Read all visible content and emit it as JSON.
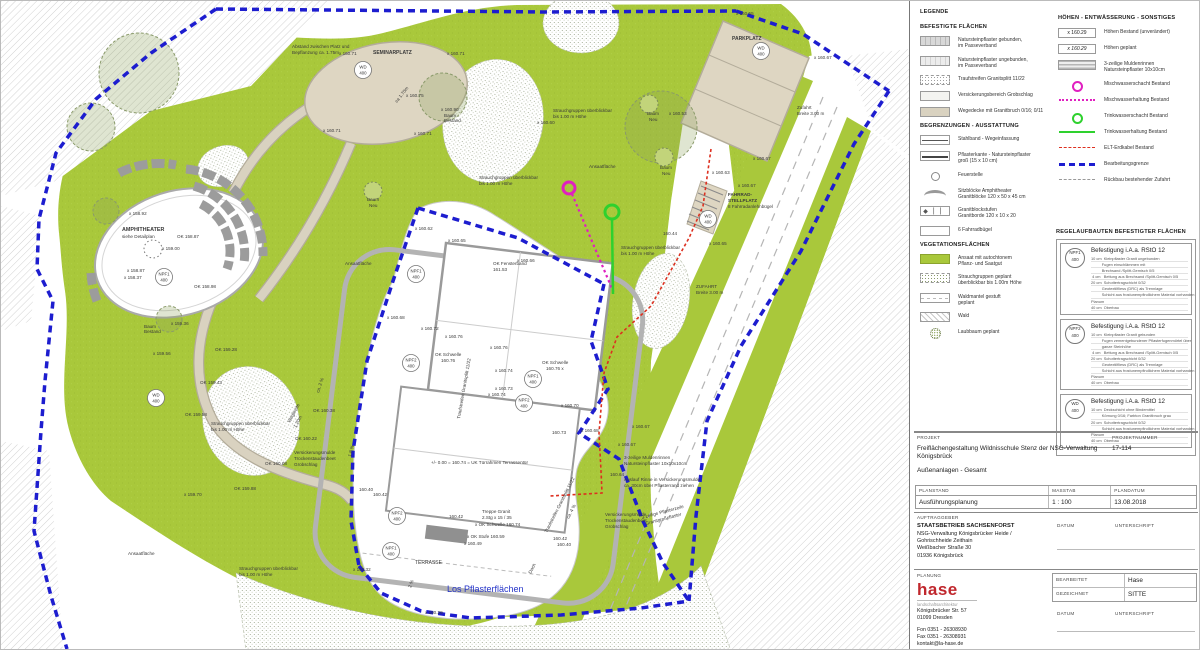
{
  "plan": {
    "colors": {
      "green": "#a9c83b",
      "beige": "#d9d2c0",
      "beige_edge": "#b3ac9a",
      "boundary_blue": "#1d1dcf",
      "sewer_magenta": "#e020c0",
      "water_green": "#2ed12e",
      "cable_red": "#dd3020",
      "label_blue": "#2433c8"
    },
    "labels": [
      {
        "t": "x 158.92",
        "x": 128,
        "y": 214
      },
      {
        "t": "AMPHITHEATER",
        "x": 121,
        "y": 230,
        "b": 1,
        "s": 5.4
      },
      {
        "t": "siehe Detailplan",
        "x": 121,
        "y": 237
      },
      {
        "t": "OK 158.87",
        "x": 176,
        "y": 237
      },
      {
        "t": "x 159.00",
        "x": 161,
        "y": 249
      },
      {
        "t": "x 158.87",
        "x": 126,
        "y": 271
      },
      {
        "t": "x 158.37",
        "x": 123,
        "y": 278
      },
      {
        "t": "OK 158.98",
        "x": 193,
        "y": 287
      },
      {
        "t": "Baum",
        "x": 143,
        "y": 327
      },
      {
        "t": "Bestand",
        "x": 143,
        "y": 332
      },
      {
        "t": "x 159.36",
        "x": 170,
        "y": 324
      },
      {
        "t": "x 159.56",
        "x": 152,
        "y": 354
      },
      {
        "t": "Abstand zwischen Platz und",
        "x": 291,
        "y": 47
      },
      {
        "t": "Bepflanzung ca. 1.75m",
        "x": 291,
        "y": 53
      },
      {
        "t": "x 160.71",
        "x": 338,
        "y": 54
      },
      {
        "t": "SEMINARPLATZ",
        "x": 372,
        "y": 53,
        "b": 1,
        "s": 5
      },
      {
        "t": "x 160.71",
        "x": 446,
        "y": 54
      },
      {
        "t": "x 160.75",
        "x": 405,
        "y": 96
      },
      {
        "t": "ca 1.70m",
        "x": 396,
        "y": 102,
        "r": -52
      },
      {
        "t": "x 160.90",
        "x": 440,
        "y": 110
      },
      {
        "t": "Baum",
        "x": 443,
        "y": 116
      },
      {
        "t": "Bestand",
        "x": 443,
        "y": 121
      },
      {
        "t": "x 160.71",
        "x": 322,
        "y": 131
      },
      {
        "t": "x 160.71",
        "x": 413,
        "y": 134
      },
      {
        "t": "x 160.55",
        "x": 735,
        "y": 14
      },
      {
        "t": "PARKPLATZ",
        "x": 731,
        "y": 39,
        "b": 1,
        "s": 5
      },
      {
        "t": "x 160.67",
        "x": 813,
        "y": 58
      },
      {
        "t": "Zufahrt",
        "x": 796,
        "y": 108
      },
      {
        "t": "Breite 3.00 m",
        "x": 796,
        "y": 114
      },
      {
        "t": "x 160.53",
        "x": 668,
        "y": 114
      },
      {
        "t": "x 160.67",
        "x": 752,
        "y": 159
      },
      {
        "t": "x 160.63",
        "x": 711,
        "y": 173
      },
      {
        "t": "x 160.67",
        "x": 737,
        "y": 186
      },
      {
        "t": "FAHRRAD-",
        "x": 727,
        "y": 195,
        "b": 1
      },
      {
        "t": "STELLPLATZ",
        "x": 727,
        "y": 201,
        "b": 1
      },
      {
        "t": "8 Fahrradanlehnbügel",
        "x": 727,
        "y": 207
      },
      {
        "t": "160.44",
        "x": 662,
        "y": 234
      },
      {
        "t": "x 160.65",
        "x": 708,
        "y": 244
      },
      {
        "t": "ZUFAHRT",
        "x": 695,
        "y": 287
      },
      {
        "t": "Breite 3.00 m",
        "x": 695,
        "y": 293
      },
      {
        "t": "x 160.60",
        "x": 536,
        "y": 123
      },
      {
        "t": "Strauchgruppen überblickbar",
        "x": 552,
        "y": 111
      },
      {
        "t": "bis 1.00 m Höhe",
        "x": 552,
        "y": 117
      },
      {
        "t": "Ansaatfläche",
        "x": 588,
        "y": 167
      },
      {
        "t": "Baum",
        "x": 646,
        "y": 114
      },
      {
        "t": "Neu",
        "x": 648,
        "y": 120
      },
      {
        "t": "Baum",
        "x": 659,
        "y": 168
      },
      {
        "t": "Neu",
        "x": 661,
        "y": 174
      },
      {
        "t": "Baum",
        "x": 366,
        "y": 200
      },
      {
        "t": "Neu",
        "x": 368,
        "y": 206
      },
      {
        "t": "Strauchgruppen überblickbar",
        "x": 478,
        "y": 178
      },
      {
        "t": "bis 1.00 m Höhe",
        "x": 478,
        "y": 184
      },
      {
        "t": "Strauchgruppen überblickbar",
        "x": 620,
        "y": 248
      },
      {
        "t": "bis 1.00 m Höhe",
        "x": 620,
        "y": 254
      },
      {
        "t": "Ansaatfläche",
        "x": 344,
        "y": 264
      },
      {
        "t": "OK 159.28",
        "x": 214,
        "y": 350
      },
      {
        "t": "OK 159.43",
        "x": 199,
        "y": 383
      },
      {
        "t": "OK 159.58",
        "x": 184,
        "y": 415
      },
      {
        "t": "Strauchgruppen überblickbar",
        "x": 210,
        "y": 424
      },
      {
        "t": "bis 1.00 m Höhe",
        "x": 210,
        "y": 430
      },
      {
        "t": "ca. 2 %",
        "x": 318,
        "y": 392,
        "r": -72
      },
      {
        "t": "Wegbreite",
        "x": 289,
        "y": 422,
        "r": -62
      },
      {
        "t": "1.20m",
        "x": 295,
        "y": 427,
        "r": -62
      },
      {
        "t": "OK 160.38",
        "x": 312,
        "y": 411
      },
      {
        "t": "OK 160.22",
        "x": 294,
        "y": 439
      },
      {
        "t": "OK 160.08",
        "x": 264,
        "y": 464
      },
      {
        "t": "Versickerungsmulde",
        "x": 293,
        "y": 453
      },
      {
        "t": "Trockenstaudenbeet",
        "x": 293,
        "y": 459
      },
      {
        "t": "Grobschlag",
        "x": 293,
        "y": 465
      },
      {
        "t": "x 159.70",
        "x": 183,
        "y": 495
      },
      {
        "t": "OK 159.88",
        "x": 233,
        "y": 489
      },
      {
        "t": "Ansaatfläche",
        "x": 127,
        "y": 554
      },
      {
        "t": "Strauchgruppen überblickbar",
        "x": 238,
        "y": 569
      },
      {
        "t": "bis 1.00 m Höhe",
        "x": 238,
        "y": 575
      },
      {
        "t": "x 160.62",
        "x": 414,
        "y": 229
      },
      {
        "t": "x 160.65",
        "x": 447,
        "y": 241
      },
      {
        "t": "OK Fensterband",
        "x": 492,
        "y": 264
      },
      {
        "t": "161.53",
        "x": 492,
        "y": 270
      },
      {
        "t": "x 160.66",
        "x": 516,
        "y": 261
      },
      {
        "t": "x 160.68",
        "x": 386,
        "y": 318
      },
      {
        "t": "x 160.72",
        "x": 420,
        "y": 329
      },
      {
        "t": "x 160.76",
        "x": 444,
        "y": 337
      },
      {
        "t": "OK Schwelle",
        "x": 434,
        "y": 355
      },
      {
        "t": "160.76",
        "x": 440,
        "y": 361
      },
      {
        "t": "x 160.76",
        "x": 489,
        "y": 348
      },
      {
        "t": "OK Schwelle",
        "x": 541,
        "y": 363
      },
      {
        "t": "160.76 x",
        "x": 545,
        "y": 369
      },
      {
        "t": "x 160.74",
        "x": 494,
        "y": 371
      },
      {
        "t": "x 160.73",
        "x": 494,
        "y": 389
      },
      {
        "t": "x 160.74",
        "x": 487,
        "y": 395
      },
      {
        "t": "x 160.70",
        "x": 560,
        "y": 406
      },
      {
        "t": "160.73",
        "x": 551,
        "y": 433
      },
      {
        "t": "x 160.68",
        "x": 580,
        "y": 431
      },
      {
        "t": "1.8 %",
        "x": 350,
        "y": 456,
        "r": -75
      },
      {
        "t": "Traufstreifen Granitsplitt 11/22",
        "x": 459,
        "y": 418,
        "r": -80
      },
      {
        "t": "Traufstreifen Granitsplitt 11/22",
        "x": 546,
        "y": 532,
        "r": -63
      },
      {
        "t": "+/-  0.00 = 160.74 = UK Türrahmen Terrassentür",
        "x": 430,
        "y": 463
      },
      {
        "t": "ca. 4 %",
        "x": 568,
        "y": 518,
        "r": -63
      },
      {
        "t": "Dach",
        "x": 530,
        "y": 573,
        "r": -63
      },
      {
        "t": "160.40",
        "x": 358,
        "y": 490
      },
      {
        "t": "160.42",
        "x": 372,
        "y": 495
      },
      {
        "t": "160.42",
        "x": 448,
        "y": 517
      },
      {
        "t": "Treppe Granit",
        "x": 481,
        "y": 512
      },
      {
        "t": "2.Stg x 15 / 35",
        "x": 481,
        "y": 518
      },
      {
        "t": "x OK Schwelle 160.74",
        "x": 474,
        "y": 525
      },
      {
        "t": "x OK Stufe 160.59",
        "x": 466,
        "y": 537
      },
      {
        "t": "x 160.49",
        "x": 463,
        "y": 544
      },
      {
        "t": "160.42",
        "x": 552,
        "y": 539
      },
      {
        "t": "160.40",
        "x": 556,
        "y": 545
      },
      {
        "t": "TERRASSE",
        "x": 414,
        "y": 563,
        "s": 5
      },
      {
        "t": "x 160.32",
        "x": 352,
        "y": 570
      },
      {
        "t": "2 %",
        "x": 410,
        "y": 587,
        "r": -70
      },
      {
        "t": "Los Pflasterflächen",
        "x": 446,
        "y": 591,
        "s": 9,
        "c": "#2433c8"
      },
      {
        "t": "x 160.29",
        "x": 424,
        "y": 613
      },
      {
        "t": "x 160.67",
        "x": 631,
        "y": 427
      },
      {
        "t": "x 160.67",
        "x": 617,
        "y": 445
      },
      {
        "t": "160.64",
        "x": 609,
        "y": 475
      },
      {
        "t": "3-zeilige Muldenrinnen",
        "x": 623,
        "y": 458
      },
      {
        "t": "Natursteinpflaster 10x10x10cm",
        "x": 623,
        "y": 464
      },
      {
        "t": "Auslauf Rinne in Versickerungsmulde",
        "x": 623,
        "y": 480
      },
      {
        "t": "ca. 30cm über Pflasterrand ziehen",
        "x": 623,
        "y": 486
      },
      {
        "t": "Versickerungsmulde",
        "x": 604,
        "y": 515
      },
      {
        "t": "Trockenstaudenbeet",
        "x": 604,
        "y": 521
      },
      {
        "t": "Grobschlag",
        "x": 604,
        "y": 527
      },
      {
        "t": "3-zeilige Pflasterzeile",
        "x": 641,
        "y": 518,
        "r": -15
      },
      {
        "t": "Granitgroßpflaster",
        "x": 645,
        "y": 524,
        "r": -15
      }
    ],
    "badges": [
      {
        "l1": "NPF1",
        "l2": "400",
        "x": 163,
        "y": 276
      },
      {
        "l1": "WD",
        "l2": "400",
        "x": 362,
        "y": 69
      },
      {
        "l1": "WD",
        "l2": "400",
        "x": 760,
        "y": 50
      },
      {
        "l1": "WD",
        "l2": "400",
        "x": 707,
        "y": 218
      },
      {
        "l1": "WD",
        "l2": "400",
        "x": 155,
        "y": 397
      },
      {
        "l1": "NPF1",
        "l2": "400",
        "x": 415,
        "y": 273
      },
      {
        "l1": "NPF2",
        "l2": "400",
        "x": 410,
        "y": 362
      },
      {
        "l1": "NPF1",
        "l2": "400",
        "x": 532,
        "y": 378
      },
      {
        "l1": "NPF2",
        "l2": "400",
        "x": 523,
        "y": 402
      },
      {
        "l1": "NPF2",
        "l2": "400",
        "x": 396,
        "y": 515
      },
      {
        "l1": "NPF1",
        "l2": "400",
        "x": 390,
        "y": 550
      }
    ]
  },
  "legend": {
    "title": "LEGENDE",
    "sections_left": [
      {
        "title": "BEFESTIGTE FLÄCHEN",
        "items": [
          {
            "sw": "pfgeb",
            "label": "Natursteinpflaster gebunden,\nim Passeverband"
          },
          {
            "sw": "pfungeb",
            "label": "Natursteinpflaster ungebunden,\nim Passeverband"
          },
          {
            "sw": "trauf",
            "label": "Traufstreifen Granitsplitt 11/22"
          },
          {
            "sw": "versick",
            "label": "Versickerungsbereich Grobschlag"
          },
          {
            "sw": "wege",
            "label": "Wegedecke mit Granitbruch 0/16; 0/11"
          }
        ]
      },
      {
        "title": "BEGRENZUNGEN - AUSSTATTUNG",
        "items": [
          {
            "sw": "stahlband",
            "label": "Stahlband - Wegeinfassung"
          },
          {
            "sw": "pflkante",
            "label": "Pflasterkante - Natursteinpflaster\ngroß (15 x 10 cm)"
          },
          {
            "sw": "feuer",
            "label": "Feuerstelle"
          },
          {
            "sw": "sitz",
            "label": "Sitzblöcke Amphitheater\nGranitblöcke 120 x 50 x 45 cm"
          },
          {
            "sw": "stufen",
            "label": "Granitblockstufen\nGranitborde 120 x 10 x 20"
          },
          {
            "sw": "buegel",
            "label": "6 Fahrradbügel"
          }
        ]
      },
      {
        "title": "VEGETATIONSFLÄCHEN",
        "items": [
          {
            "sw": "ansaat",
            "label": "Ansaat mit autochtonem\nPflanz- und Saatgut"
          },
          {
            "sw": "strauch",
            "label": "Strauchgruppen geplant\nüberblickbar bis 1.00m Höhe"
          },
          {
            "sw": "waldm",
            "label": "Waldmantel gestuft\ngeplant"
          },
          {
            "sw": "wald",
            "label": "Wald"
          },
          {
            "sw": "laub",
            "label": "Laubbaum geplant"
          }
        ]
      }
    ],
    "section_right": {
      "title": "HÖHEN - ENTWÄSSERUNG - SONSTIGES",
      "items": [
        {
          "sw": "hbox",
          "swatch_text": "x 160.29",
          "label": "Höhen Bestand (unverändert)"
        },
        {
          "sw": "hboxi",
          "swatch_text": "x 160.29",
          "label": "Höhen geplant"
        },
        {
          "sw": "mulden",
          "label": "3-zeilige Muldenrinnen\nNatursteinpflaster 10x10cm"
        },
        {
          "sw": "mschacht",
          "label": "Mischwasserschacht Bestand"
        },
        {
          "sw": "mhalt",
          "label": "Mischwasserhaltung Bestand"
        },
        {
          "sw": "tschacht",
          "label": "Trinkwasserschacht Bestand"
        },
        {
          "sw": "thalt",
          "label": "Trinkwasserhaltung Bestand"
        },
        {
          "sw": "elt",
          "label": "ELT-Erdkabel Bestand"
        },
        {
          "sw": "bgrenze",
          "label": "Bearbeitungsgrenze"
        },
        {
          "sw": "rueckbau",
          "label": "Rückbau bestehender Zufahrt"
        }
      ]
    },
    "aufbauten": {
      "title": "REGELAUFBAUTEN BEFESTIGTER FLÄCHEN",
      "entries": [
        {
          "badge1": "NPF1",
          "badge2": "400",
          "heading": "Befestigung i.A.a. RStO 12",
          "lines": [
            "10 cm  Kleinpflaster Granit ungebunden",
            "          Fugen einschlämmen mit",
            "          Brechsand /Splitt-Gemisch 0/5",
            " 4 cm   Bettung aus Brechsand /Splitt-Gemisch 0/5",
            "20 cm  Schottertragschicht 0/32",
            "          Geotextilfliess (DRC) als Trennlage",
            "          Schicht aus frostunempfindlichem Material vorhanden",
            "Planum",
            "40 cm  Oberbau"
          ]
        },
        {
          "badge1": "NPF2",
          "badge2": "400",
          "heading": "Befestigung i.A.a. RStO 12",
          "lines": [
            "10 cm  Kleinpflaster Granit gebunden",
            "          Fugen zementgebundener Pflasterfugenmörtel über",
            "          ganze Steinhöhe",
            " 4 cm   Bettung aus Brechsand /Splitt-Gemisch 0/5",
            "20 cm  Schottertragschicht 0/32",
            "          Geotextilfliess (DRC) als Trennlage",
            "          Schicht aus frostunempfindlichem Material vorhanden",
            "Planum",
            "40 cm  Oberbau"
          ]
        },
        {
          "badge1": "WD",
          "badge2": "400",
          "heading": "Befestigung i.A.a. RStO 12",
          "lines": [
            "10 cm  Deckschicht ohne Bindemittel",
            "          Körnung 0/16; Farbton Granitbruch grau",
            "20 cm  Schottertragschicht 0/32",
            "          Schicht aus frostunempfindlichem Material vorhanden",
            "Planum",
            "40 cm  Oberbau"
          ]
        }
      ]
    }
  },
  "titleblock": {
    "projekt_label": "PROJEKT",
    "projektnummer_label": "PROJEKTNUMMER",
    "project_title": "Freiflächengestaltung Wildnisschule Stenz der NSG-Verwaltung Königsbrück",
    "project_number": "17-114",
    "subtitle": "Außenanlagen - Gesamt",
    "planstand_label": "PLANSTAND",
    "massstab_label": "MASSTAB",
    "plandatum_label": "PLANDATUM",
    "planstand": "Ausführungsplanung",
    "massstab": "1 : 100",
    "plandatum": "13.08.2018",
    "auftraggeber_label": "AUFTRAGGEBER",
    "auftraggeber": [
      "STAATSBETRIEB SACHSENFORST",
      "NSG-Verwaltung Königsbrücker Heide /",
      "Gohrischheide Zeithain",
      "Weißbacher Straße 30",
      "01936 Königsbrück"
    ],
    "datum_label": "DATUM",
    "unterschrift_label": "UNTERSCHRIFT",
    "planung_label": "PLANUNG",
    "logo": "hase",
    "logo_sub": "landschaftsarchitektur",
    "planung_address": [
      "Königsbrücker Str. 57",
      "01099 Dresden"
    ],
    "planung_contact": [
      "Fon 0351 - 26308930",
      "Fax 0351 - 26308931",
      "kontakt@la-hase.de"
    ],
    "bearbeitet_label": "BEARBEITET",
    "bearbeitet": "Hase",
    "gezeichnet_label": "GEZEICHNET",
    "gezeichnet": "SITTE"
  }
}
